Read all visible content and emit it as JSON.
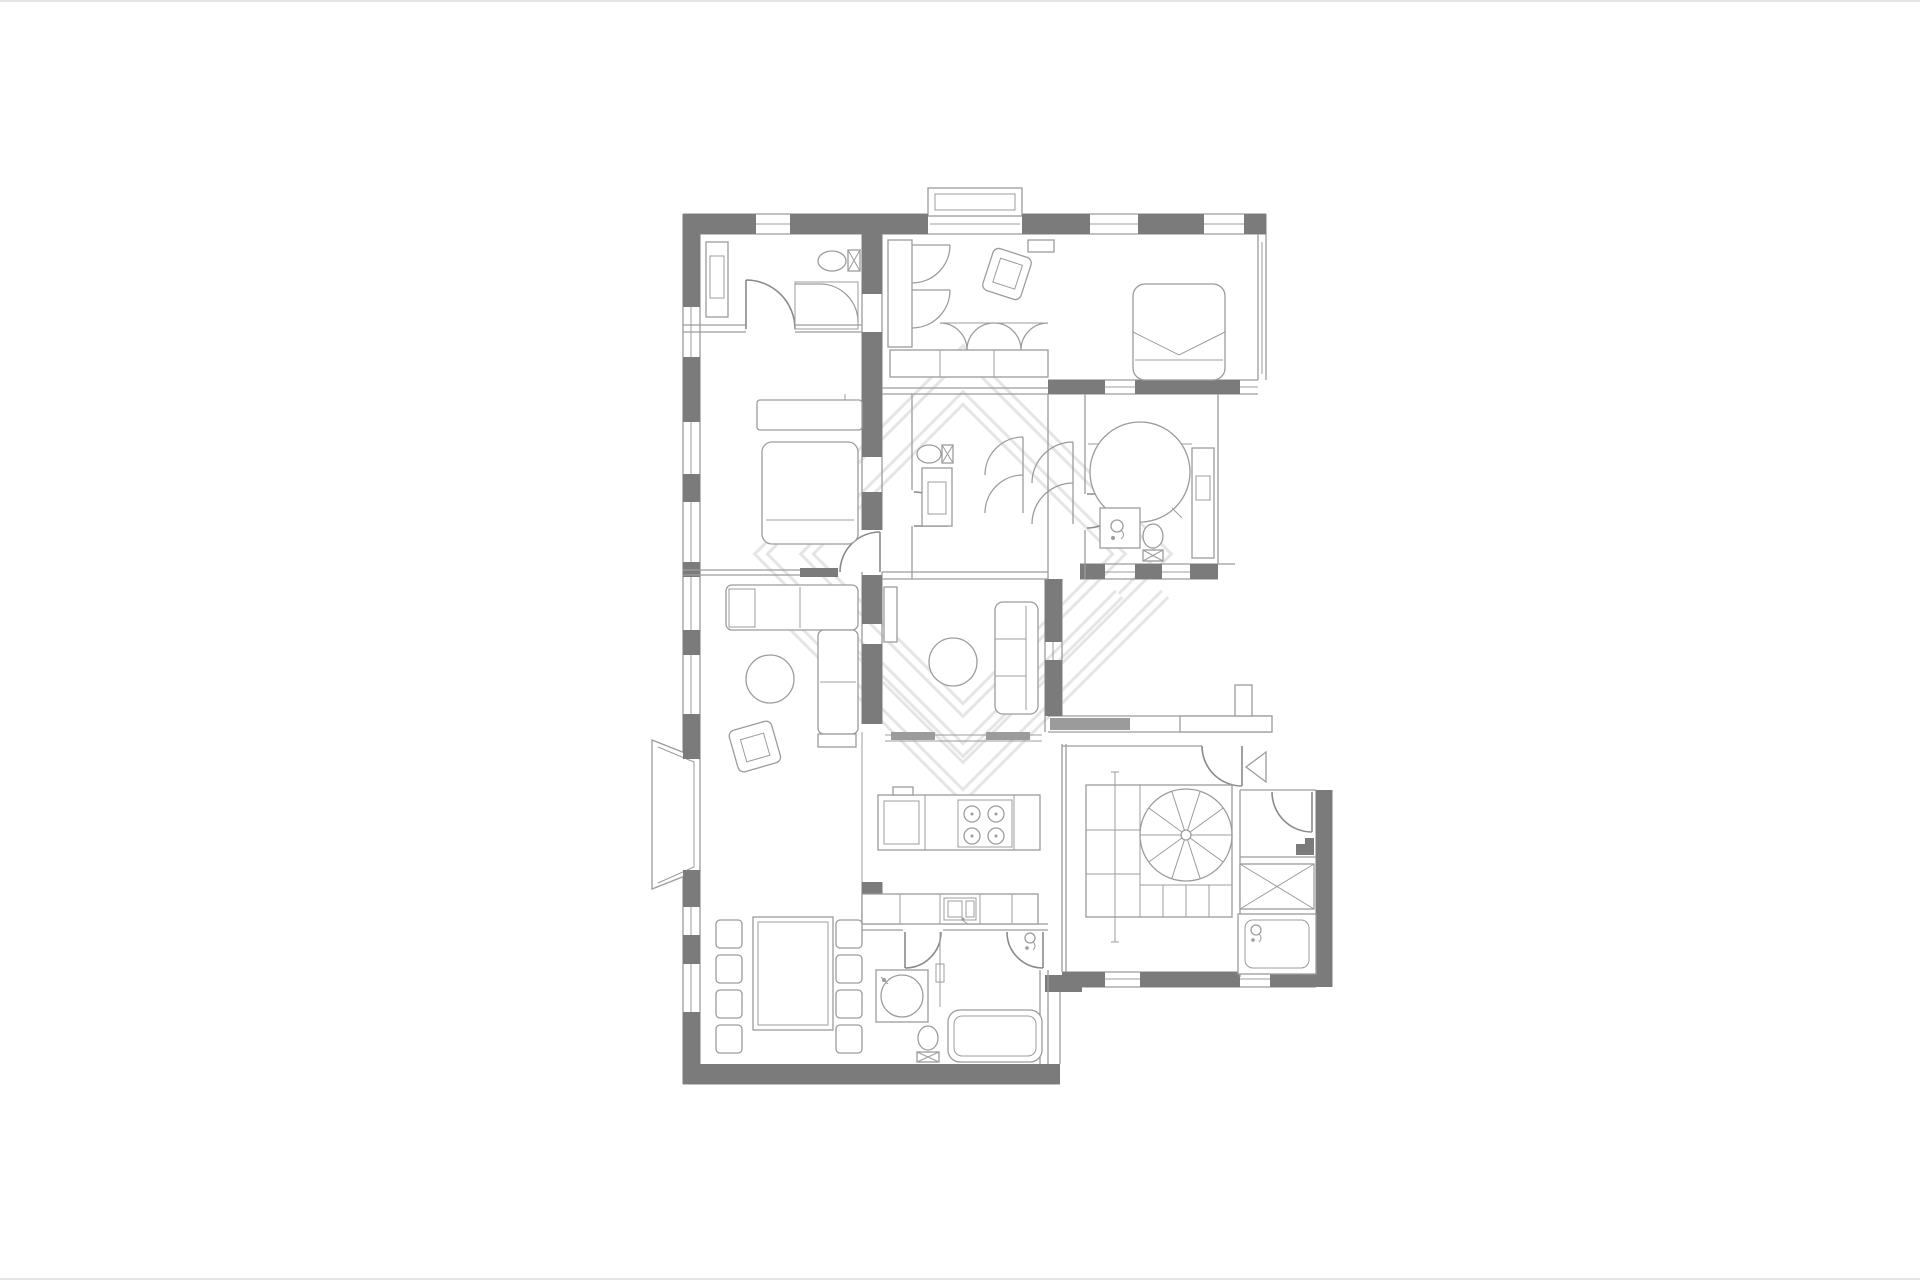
{
  "page": {
    "background": "#ffffff",
    "frame_color": "#e6e6e6"
  },
  "drawing": {
    "type": "architectural-floor-plan",
    "colors": {
      "wall": "#7b7b7b",
      "line": "#9c9c9c",
      "line-dark": "#8a8a8a",
      "panel": "#9b9b9b",
      "watermark": "#e5e5e5",
      "frame": "#e6e6e6",
      "bg": "#ffffff"
    },
    "watermark": "nested-diamond-and-chevron-logo",
    "rooms": [
      "entrance-hall",
      "walk-in-closet",
      "master-bedroom",
      "bedroom",
      "corridor",
      "shower-room",
      "main-bathroom",
      "living-room",
      "family-room",
      "kitchen",
      "dining-area",
      "guest-bathroom",
      "stair-hall",
      "storage-closet",
      "shower-cabin"
    ],
    "features": [
      "spiral-staircase",
      "west-bay-window",
      "north-bay-window",
      "entry-direction-arrow",
      "sliding-glass-doors",
      "window-openings",
      "kitchen-island-with-cooktop",
      "kitchen-sink-counter",
      "dining-table-with-8-chairs",
      "round-bathtub",
      "double-beds",
      "corner-sofa",
      "round-coffee-table",
      "wardrobe-units",
      "toilets",
      "washbasins",
      "bathtub",
      "shaft-cross-box"
    ]
  }
}
